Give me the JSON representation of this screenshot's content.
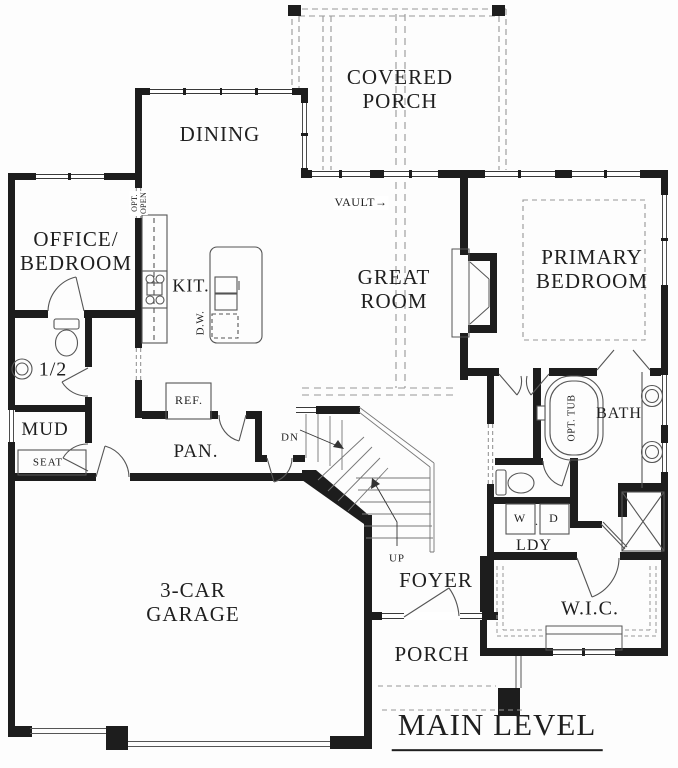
{
  "drawing": {
    "title": "MAIN LEVEL",
    "labels": {
      "covered_porch": [
        "COVERED",
        "PORCH"
      ],
      "dining": "DINING",
      "office_bedroom": [
        "OFFICE/",
        "BEDROOM"
      ],
      "kitchen": "KIT.",
      "dishwasher": "D.W.",
      "optional_opening": [
        "OPT.",
        "OPEN"
      ],
      "vault": "VAULT→",
      "great_room": [
        "GREAT",
        "ROOM"
      ],
      "primary_bedroom": [
        "PRIMARY",
        "BEDROOM"
      ],
      "half_bath": "1/2",
      "mud_room": "MUD",
      "seat": "SEAT",
      "refrigerator": "REF.",
      "pantry": "PAN.",
      "stairs_down": "DN",
      "stairs_up": "UP",
      "foyer": "FOYER",
      "optional_tub": "OPT. TUB",
      "bath": "BATH",
      "washer": "W",
      "washer_dryer_dot": ".",
      "dryer": "D",
      "laundry": "LDY",
      "walk_in_closet": "W.I.C.",
      "porch": "PORCH",
      "garage": [
        "3-CAR",
        "GARAGE"
      ]
    },
    "colors": {
      "wall": "#1d1d1d",
      "thin_line": "#555555",
      "dashed_line": "#979797",
      "text": "#1f1f1f",
      "background": "#ffffff"
    }
  }
}
